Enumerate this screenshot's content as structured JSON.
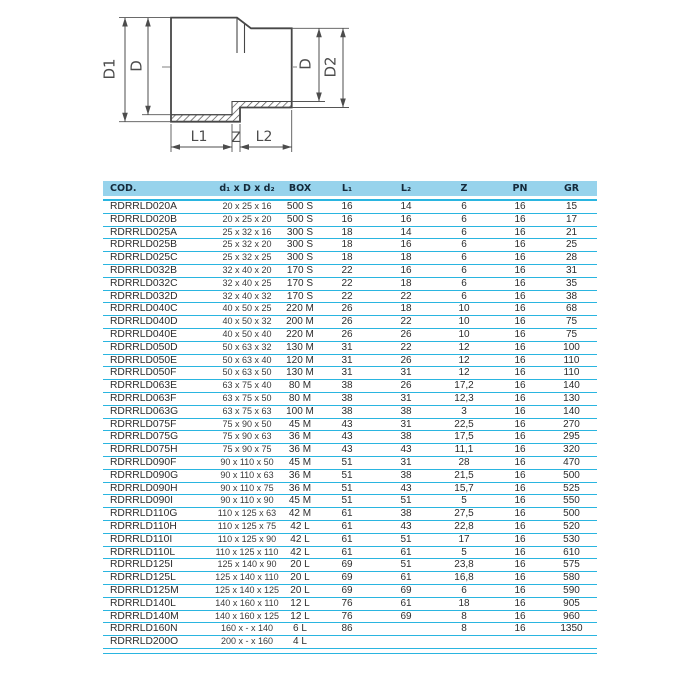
{
  "theme": {
    "header-bg": "#97d3ec",
    "header-text": "#14293a",
    "line": "#2ab5e0",
    "body-text": "#2d2d2d",
    "draw": "#4c4c4c"
  },
  "diagram": {
    "labels": {
      "d1": "D1",
      "d_left": "D",
      "d_right": "D",
      "d2": "D2",
      "l1": "L1",
      "z": "Z",
      "l2": "L2"
    }
  },
  "table": {
    "columns": [
      "COD.",
      "d₁ x D x d₂",
      "BOX",
      "L₁",
      "L₂",
      "Z",
      "PN",
      "GR"
    ],
    "rows": [
      {
        "cod": "RDRRLD020A",
        "dim": "20 x 25 x 16",
        "box": "500 S",
        "l1": "16",
        "l2": "14",
        "z": "6",
        "pn": "16",
        "gr": "15"
      },
      {
        "cod": "RDRRLD020B",
        "dim": "20 x 25 x 20",
        "box": "500 S",
        "l1": "16",
        "l2": "16",
        "z": "6",
        "pn": "16",
        "gr": "17"
      },
      {
        "cod": "RDRRLD025A",
        "dim": "25 x 32 x 16",
        "box": "300 S",
        "l1": "18",
        "l2": "14",
        "z": "6",
        "pn": "16",
        "gr": "21"
      },
      {
        "cod": "RDRRLD025B",
        "dim": "25 x 32 x 20",
        "box": "300 S",
        "l1": "18",
        "l2": "16",
        "z": "6",
        "pn": "16",
        "gr": "25"
      },
      {
        "cod": "RDRRLD025C",
        "dim": "25 x 32 x 25",
        "box": "300 S",
        "l1": "18",
        "l2": "18",
        "z": "6",
        "pn": "16",
        "gr": "28"
      },
      {
        "cod": "RDRRLD032B",
        "dim": "32 x 40 x 20",
        "box": "170 S",
        "l1": "22",
        "l2": "16",
        "z": "6",
        "pn": "16",
        "gr": "31"
      },
      {
        "cod": "RDRRLD032C",
        "dim": "32 x 40 x 25",
        "box": "170 S",
        "l1": "22",
        "l2": "18",
        "z": "6",
        "pn": "16",
        "gr": "35"
      },
      {
        "cod": "RDRRLD032D",
        "dim": "32 x 40 x 32",
        "box": "170 S",
        "l1": "22",
        "l2": "22",
        "z": "6",
        "pn": "16",
        "gr": "38"
      },
      {
        "cod": "RDRRLD040C",
        "dim": "40 x 50 x 25",
        "box": "220 M",
        "l1": "26",
        "l2": "18",
        "z": "10",
        "pn": "16",
        "gr": "68"
      },
      {
        "cod": "RDRRLD040D",
        "dim": "40 x 50 x 32",
        "box": "200 M",
        "l1": "26",
        "l2": "22",
        "z": "10",
        "pn": "16",
        "gr": "75"
      },
      {
        "cod": "RDRRLD040E",
        "dim": "40 x 50 x 40",
        "box": "220 M",
        "l1": "26",
        "l2": "26",
        "z": "10",
        "pn": "16",
        "gr": "75"
      },
      {
        "cod": "RDRRLD050D",
        "dim": "50 x 63 x 32",
        "box": "130 M",
        "l1": "31",
        "l2": "22",
        "z": "12",
        "pn": "16",
        "gr": "100"
      },
      {
        "cod": "RDRRLD050E",
        "dim": "50 x 63 x 40",
        "box": "120 M",
        "l1": "31",
        "l2": "26",
        "z": "12",
        "pn": "16",
        "gr": "110"
      },
      {
        "cod": "RDRRLD050F",
        "dim": "50 x 63 x 50",
        "box": "130 M",
        "l1": "31",
        "l2": "31",
        "z": "12",
        "pn": "16",
        "gr": "110"
      },
      {
        "cod": "RDRRLD063E",
        "dim": "63 x 75 x 40",
        "box": "80 M",
        "l1": "38",
        "l2": "26",
        "z": "17,2",
        "pn": "16",
        "gr": "140"
      },
      {
        "cod": "RDRRLD063F",
        "dim": "63 x 75 x 50",
        "box": "80 M",
        "l1": "38",
        "l2": "31",
        "z": "12,3",
        "pn": "16",
        "gr": "130"
      },
      {
        "cod": "RDRRLD063G",
        "dim": "63 x 75 x 63",
        "box": "100 M",
        "l1": "38",
        "l2": "38",
        "z": "3",
        "pn": "16",
        "gr": "140"
      },
      {
        "cod": "RDRRLD075F",
        "dim": "75 x 90 x 50",
        "box": "45 M",
        "l1": "43",
        "l2": "31",
        "z": "22,5",
        "pn": "16",
        "gr": "270"
      },
      {
        "cod": "RDRRLD075G",
        "dim": "75 x 90 x 63",
        "box": "36 M",
        "l1": "43",
        "l2": "38",
        "z": "17,5",
        "pn": "16",
        "gr": "295"
      },
      {
        "cod": "RDRRLD075H",
        "dim": "75 x 90 x 75",
        "box": "36 M",
        "l1": "43",
        "l2": "43",
        "z": "11,1",
        "pn": "16",
        "gr": "320"
      },
      {
        "cod": "RDRRLD090F",
        "dim": "90 x 110 x 50",
        "box": "45 M",
        "l1": "51",
        "l2": "31",
        "z": "28",
        "pn": "16",
        "gr": "470"
      },
      {
        "cod": "RDRRLD090G",
        "dim": "90 x 110 x 63",
        "box": "36 M",
        "l1": "51",
        "l2": "38",
        "z": "21,5",
        "pn": "16",
        "gr": "500"
      },
      {
        "cod": "RDRRLD090H",
        "dim": "90 x 110 x 75",
        "box": "36 M",
        "l1": "51",
        "l2": "43",
        "z": "15,7",
        "pn": "16",
        "gr": "525"
      },
      {
        "cod": "RDRRLD090I",
        "dim": "90 x 110 x 90",
        "box": "45 M",
        "l1": "51",
        "l2": "51",
        "z": "5",
        "pn": "16",
        "gr": "550"
      },
      {
        "cod": "RDRRLD110G",
        "dim": "110 x 125 x 63",
        "box": "42 M",
        "l1": "61",
        "l2": "38",
        "z": "27,5",
        "pn": "16",
        "gr": "500"
      },
      {
        "cod": "RDRRLD110H",
        "dim": "110 x 125 x 75",
        "box": "42 L",
        "l1": "61",
        "l2": "43",
        "z": "22,8",
        "pn": "16",
        "gr": "520"
      },
      {
        "cod": "RDRRLD110I",
        "dim": "110 x 125 x 90",
        "box": "42 L",
        "l1": "61",
        "l2": "51",
        "z": "17",
        "pn": "16",
        "gr": "530"
      },
      {
        "cod": "RDRRLD110L",
        "dim": "110 x 125 x 110",
        "box": "42 L",
        "l1": "61",
        "l2": "61",
        "z": "5",
        "pn": "16",
        "gr": "610"
      },
      {
        "cod": "RDRRLD125I",
        "dim": "125 x 140 x 90",
        "box": "20 L",
        "l1": "69",
        "l2": "51",
        "z": "23,8",
        "pn": "16",
        "gr": "575"
      },
      {
        "cod": "RDRRLD125L",
        "dim": "125 x 140 x 110",
        "box": "20 L",
        "l1": "69",
        "l2": "61",
        "z": "16,8",
        "pn": "16",
        "gr": "580"
      },
      {
        "cod": "RDRRLD125M",
        "dim": "125 x 140 x 125",
        "box": "20 L",
        "l1": "69",
        "l2": "69",
        "z": "6",
        "pn": "16",
        "gr": "590"
      },
      {
        "cod": "RDRRLD140L",
        "dim": "140 x 160 x 110",
        "box": "12 L",
        "l1": "76",
        "l2": "61",
        "z": "18",
        "pn": "16",
        "gr": "905"
      },
      {
        "cod": "RDRRLD140M",
        "dim": "140 x 160 x 125",
        "box": "12 L",
        "l1": "76",
        "l2": "69",
        "z": "8",
        "pn": "16",
        "gr": "960"
      },
      {
        "cod": "RDRRLD160N",
        "dim": "160 x - x 140",
        "box": "6 L",
        "l1": "86",
        "l2": "",
        "z": "8",
        "pn": "16",
        "gr": "1350"
      },
      {
        "cod": "RDRRLD200O",
        "dim": "200 x - x 160",
        "box": "4 L",
        "l1": "",
        "l2": "",
        "z": "",
        "pn": "",
        "gr": ""
      }
    ]
  }
}
